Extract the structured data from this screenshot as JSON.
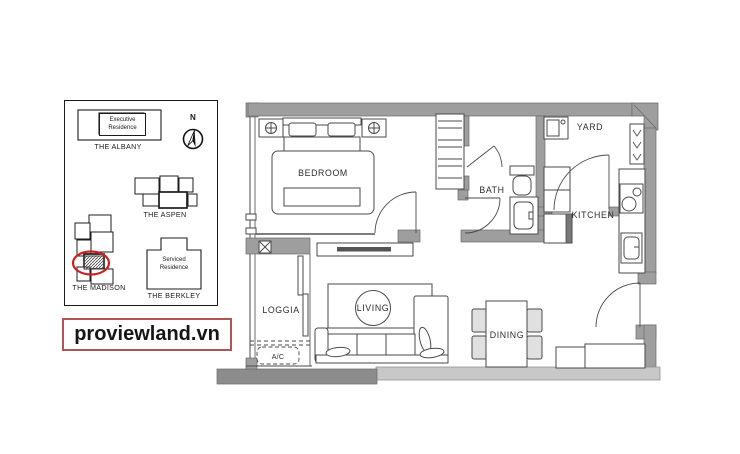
{
  "watermark": {
    "text": "proviewland.vn"
  },
  "site_map": {
    "north_label": "N",
    "buildings": {
      "albany": {
        "type_label": "Executive Residence",
        "name": "THE ALBANY"
      },
      "aspen": {
        "name": "THE ASPEN"
      },
      "madison": {
        "name": "THE MADISON"
      },
      "berkley": {
        "type_label": "Serviced Residence",
        "name": "THE BERKLEY"
      }
    }
  },
  "floor_plan": {
    "room_labels": {
      "bedroom": "BEDROOM",
      "bath": "BATH",
      "yard": "YARD",
      "kitchen": "KITCHEN",
      "loggia": "LOGGIA",
      "living": "LIVING",
      "dining": "DINING",
      "ac_unit": "A/C"
    }
  },
  "colors": {
    "wall_gray": "#9e9e9e",
    "wall_dark_gray": "#8c8c8c",
    "wall_light_gray": "#c8c8c8",
    "line_dark": "#4a4a4a",
    "highlight_red": "#cf2020",
    "watermark_border_red": "#b15454"
  }
}
